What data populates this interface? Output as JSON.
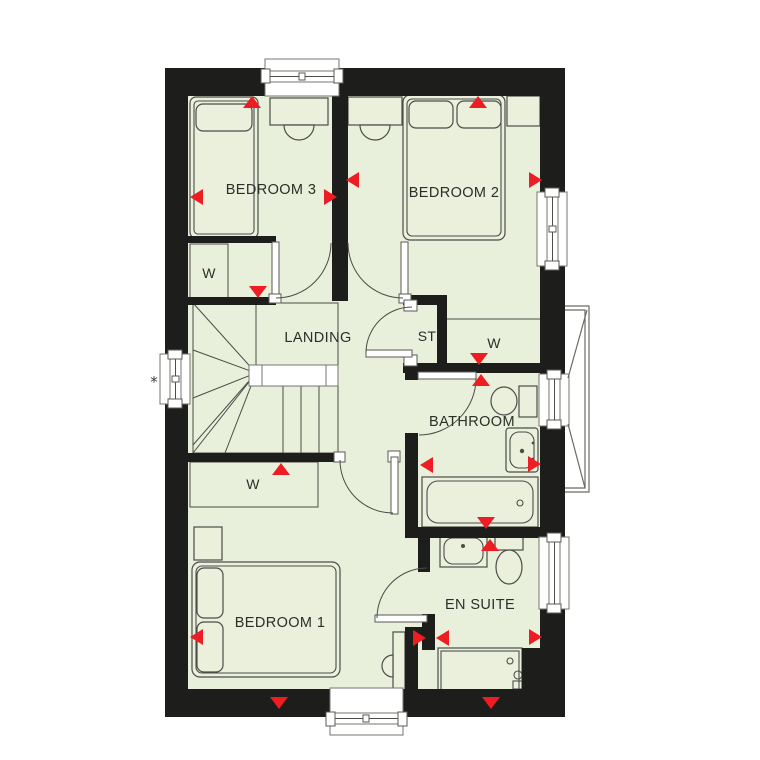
{
  "palette": {
    "floor": "#e8efda",
    "wall": "#1d1d1b",
    "fixture": "#eaf0dc",
    "line": "#4c4c48",
    "marker": "#ee1c23"
  },
  "labels": {
    "bedroom3": "BEDROOM 3",
    "bedroom2": "BEDROOM 2",
    "bedroom1": "BEDROOM 1",
    "landing": "LANDING",
    "store": "ST",
    "bathroom": "BATHROOM",
    "ensuite": "EN SUITE",
    "wardrobe": "W",
    "asterisk": "*"
  },
  "markers": {
    "meaning": "red-dimension-arrows",
    "count": 20
  }
}
